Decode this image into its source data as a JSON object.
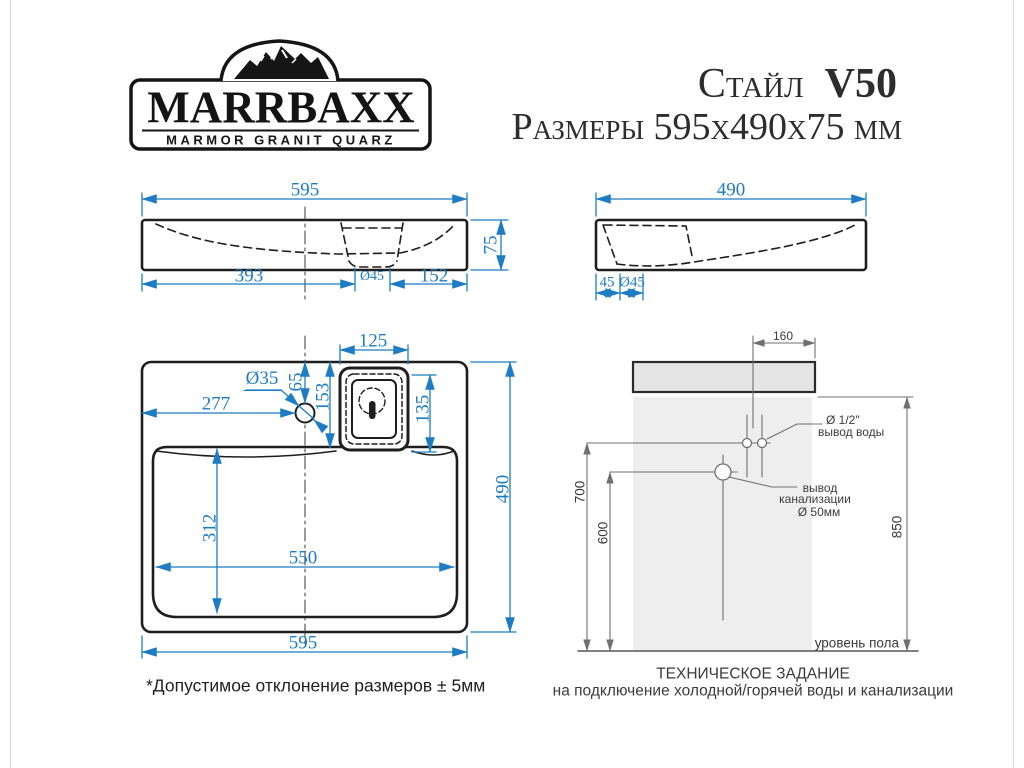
{
  "logo": {
    "brand": "MARRBAXX",
    "tagline": "MARMOR GRANIT QUARZ"
  },
  "header": {
    "model_name": "Стайл",
    "model_code": "V50",
    "dimensions_line": "Размеры 595х490х75 мм"
  },
  "front_view": {
    "width": "595",
    "height": "75",
    "left_to_drain": "393",
    "drain_diameter": "Ø45",
    "drain_to_right": "152"
  },
  "side_view": {
    "depth": "490",
    "drain_offset": "45",
    "drain_diameter": "Ø45"
  },
  "top_view": {
    "drain_box_width": "125",
    "faucet_hole_diameter": "Ø35",
    "faucet_offset_from_back": "65",
    "drain_offset_from_back": "153",
    "faucet_from_left": "277",
    "drain_box_height": "135",
    "basin_inner_depth": "312",
    "basin_inner_width": "550",
    "depth": "490",
    "width": "595"
  },
  "installation": {
    "offset_water": "160",
    "water_outlet_size": "Ø 1/2\"",
    "water_outlet_label": "вывод воды",
    "sewage_label_line1": "вывод",
    "sewage_label_line2": "канализации",
    "sewage_size": "Ø 50мм",
    "height_water": "700",
    "height_sewage": "600",
    "height_rim": "850",
    "floor_label": "уровень пола"
  },
  "notes": {
    "tolerance": "*Допустимое отклонение размеров ± 5мм",
    "tech_title": "ТЕХНИЧЕСКОЕ ЗАДАНИЕ",
    "tech_subtitle": "на подключение холодной/горячей воды и канализации"
  },
  "colors": {
    "dimension_blue": "#1d7cc3",
    "outline_black": "#1e1e1e",
    "install_gray": "#707070",
    "sink_fill": "#e5e5e5",
    "wall_fill": "#eeeeee"
  }
}
